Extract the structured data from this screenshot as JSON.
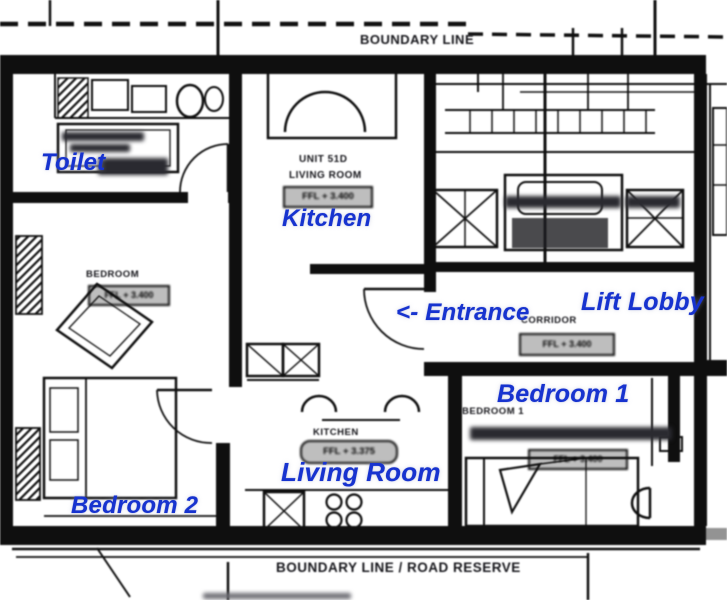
{
  "annotations": {
    "toilet": "Toilet",
    "kitchen": "Kitchen",
    "entrance": "<- Entrance",
    "lift_lobby": "Lift Lobby",
    "bedroom1": "Bedroom 1",
    "bedroom2": "Bedroom 2",
    "living_room": "Living Room"
  },
  "plan_text": {
    "boundary_top": "BOUNDARY LINE",
    "boundary_bottom": "BOUNDARY LINE / ROAD RESERVE",
    "unit_line1": "UNIT 51D",
    "unit_line2": "LIVING ROOM",
    "unit_ffl": "FFL + 3.400",
    "bedroom2_name": "BEDROOM",
    "bedroom2_ffl": "FFL + 3.400",
    "corridor_name": "CORRIDOR",
    "corridor_ffl": "FFL + 3.400",
    "bedroom1_name": "BEDROOM 1",
    "bedroom1_ffl": "FFL + 3.400",
    "kitchen_name": "KITCHEN",
    "kitchen_ffl": "FFL + 3.375"
  },
  "colors": {
    "annotation_blue": "#1733cf",
    "plan_ink": "#141414",
    "background": "#ffffff"
  }
}
